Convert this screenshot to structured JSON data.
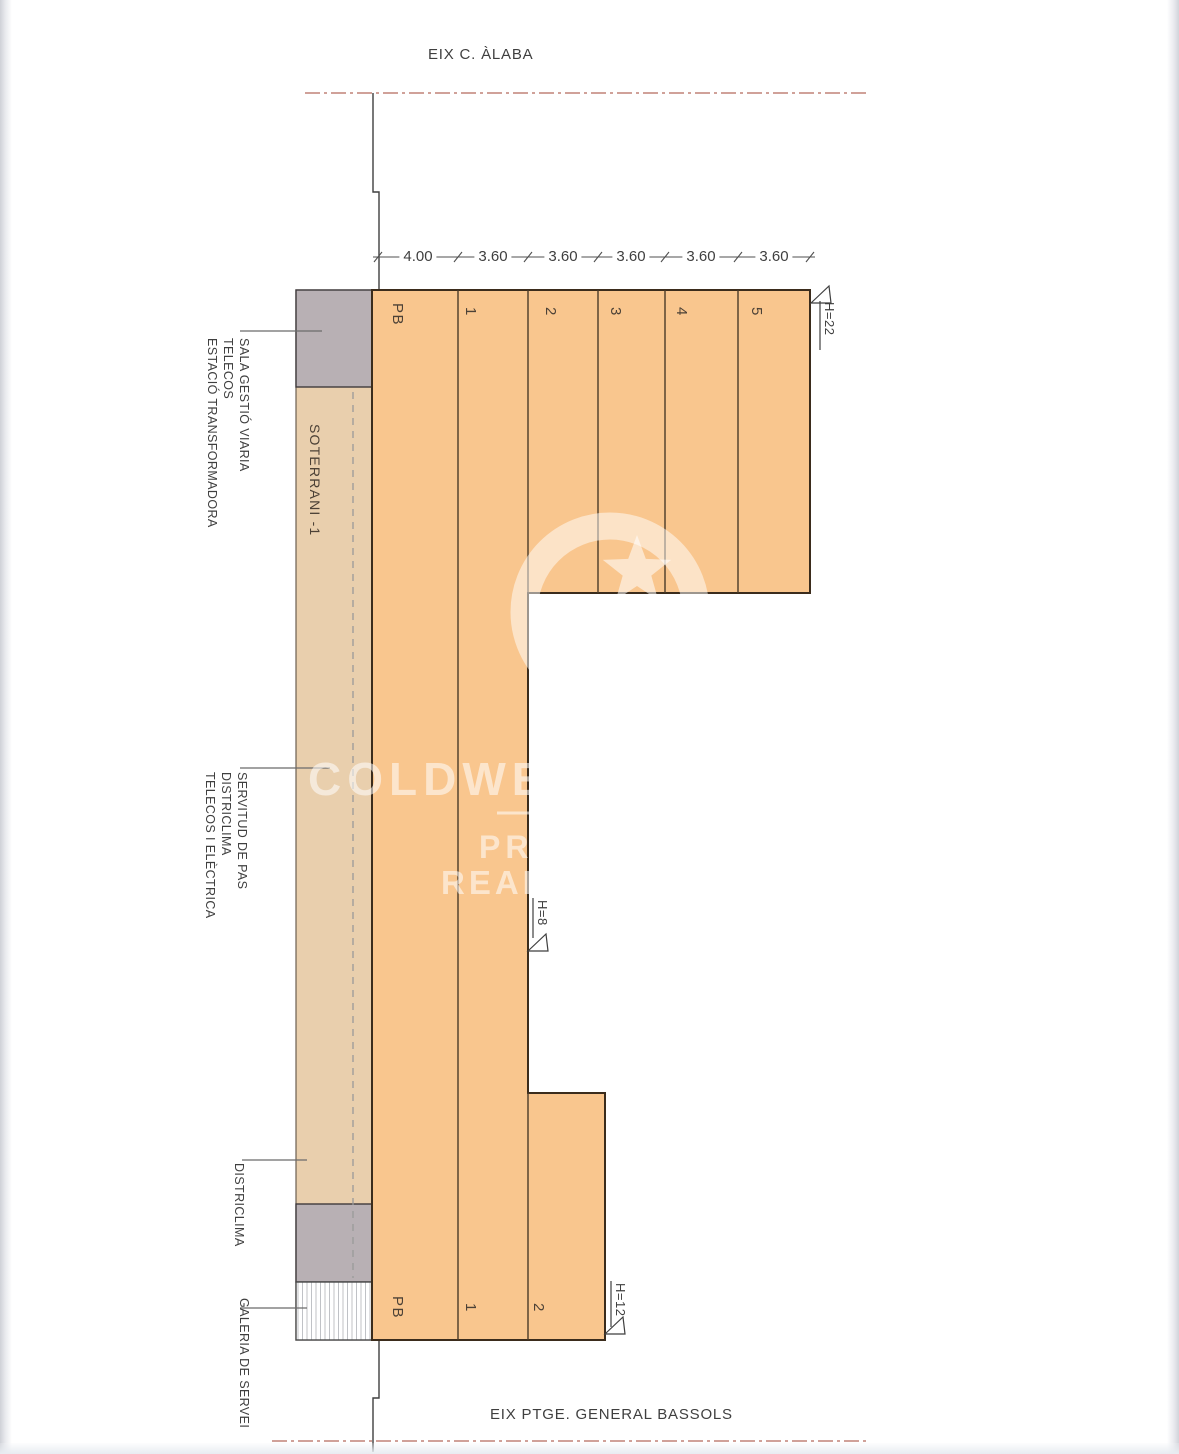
{
  "drawing": {
    "street_top": "EIX C. ÀLABA",
    "street_bottom": "EIX PTGE. GENERAL BASSOLS",
    "underground_label": "SOTERRANI -1",
    "dimension_values": [
      "4.00",
      "3.60",
      "3.60",
      "3.60",
      "3.60",
      "3.60"
    ],
    "floors_top": [
      "PB",
      "1",
      "2",
      "3",
      "4",
      "5"
    ],
    "floors_bottom": [
      "PB",
      "1",
      "2"
    ],
    "height_markers": {
      "tall": "H=22",
      "low": "H=8",
      "mid": "H=12"
    },
    "annotations": {
      "top_group": [
        "SALA GESTIÓ VIARIA",
        "TELECOS",
        "ESTACIÓ TRANSFORMADORA"
      ],
      "middle_group": [
        "SERVITUD DE PAS",
        "DISTRICLIMA",
        "TELECOS I ELÈCTRICA"
      ],
      "districlima": "DISTRICLIMA",
      "galeria": "GALERIA DE SERVEI"
    }
  },
  "watermark": {
    "brand": "COLDWELL",
    "line2": "PRESTIGE",
    "line3": "REAL ESTATE"
  },
  "colors": {
    "building_fill": "#f9c68e",
    "underground_fill": "#e9cfad",
    "technical_block_fill": "#b8b0b4",
    "building_outline": "#3b2c1c",
    "axis_dashed_red": "#b5695c",
    "label_text": "#3f3f3f"
  }
}
